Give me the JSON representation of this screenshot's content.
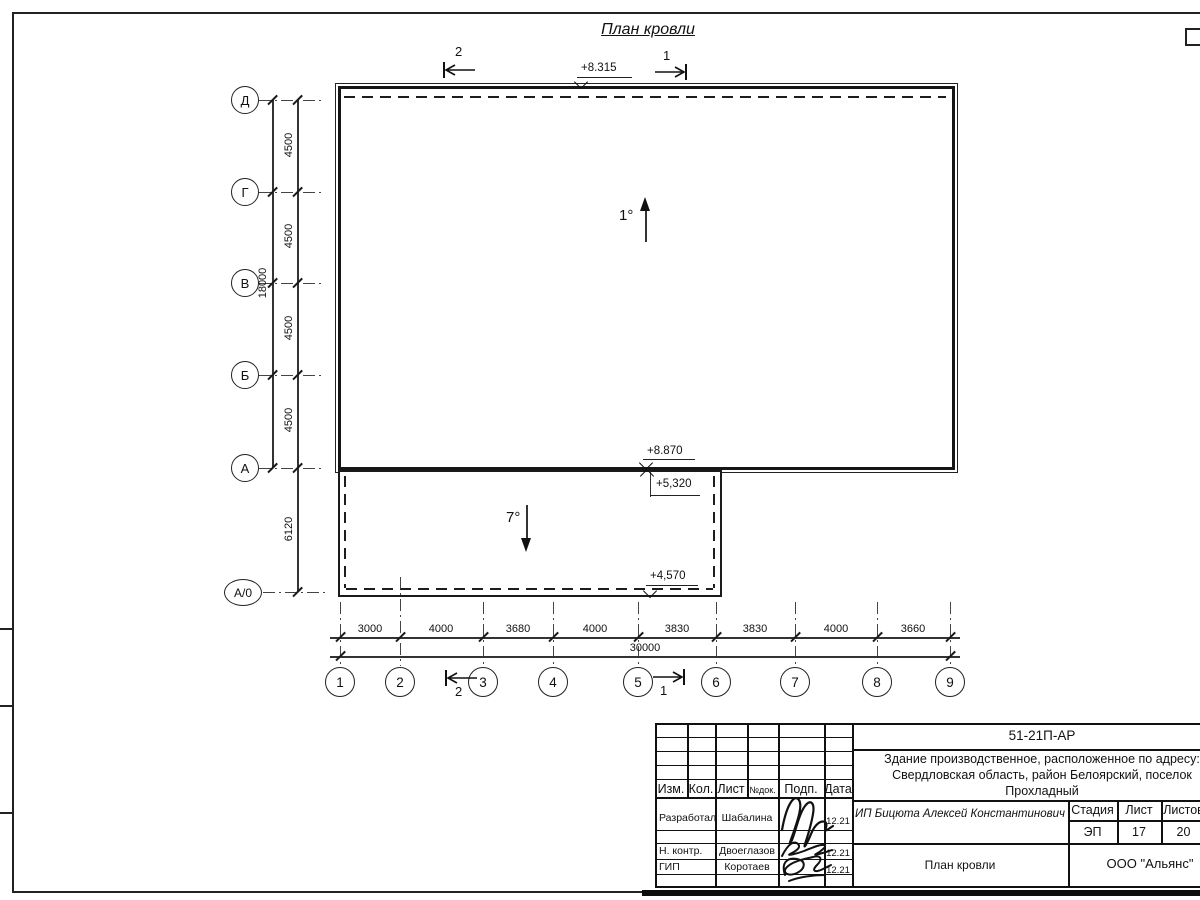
{
  "plan": {
    "title": "План кровли",
    "elevations": {
      "roof_main": "+8.315",
      "edge_main": "+8.870",
      "annex_high": "+5,320",
      "annex_low": "+4,570"
    },
    "slopes": {
      "main": "1°",
      "annex": "7°"
    },
    "sections": {
      "s1": "1",
      "s2": "2"
    }
  },
  "axes": {
    "left": [
      "Д",
      "Г",
      "В",
      "Б",
      "А",
      "А/0"
    ],
    "bottom": [
      "1",
      "2",
      "3",
      "4",
      "5",
      "6",
      "7",
      "8",
      "9"
    ]
  },
  "dimensions": {
    "vertical_segments": [
      "4500",
      "4500",
      "4500",
      "4500"
    ],
    "vertical_total": "18000",
    "annex_depth": "6120",
    "horizontal_segments": [
      "3000",
      "4000",
      "3680",
      "4000",
      "3830",
      "3830",
      "4000",
      "3660"
    ],
    "horizontal_total": "30000"
  },
  "titleblock": {
    "doc_code": "51-21П-АР",
    "address_line1": "Здание производственное, расположенное по адресу:",
    "address_line2": "Свердловская область, район Белоярский, поселок",
    "address_line3": "Прохладный",
    "customer": "ИП Бицюта Алексей Константинович",
    "columns": {
      "izm": "Изм.",
      "kol": "Кол.",
      "list": "Лист",
      "ndok": "№док.",
      "podp": "Подп.",
      "data": "Дата"
    },
    "rows": [
      {
        "role": "Разработал",
        "name": "Шабалина",
        "date": "12.21"
      },
      {
        "role": "Н. контр.",
        "name": "Двоеглазов",
        "date": "12.21"
      },
      {
        "role": "ГИП",
        "name": "Коротаев",
        "date": "12.21"
      }
    ],
    "stage_label": "Стадия",
    "stage": "ЭП",
    "sheet_label": "Лист",
    "sheet": "17",
    "sheets_label": "Листов",
    "sheets": "20",
    "drawing_name": "План кровли",
    "organization": "ООО \"Альянс\""
  }
}
